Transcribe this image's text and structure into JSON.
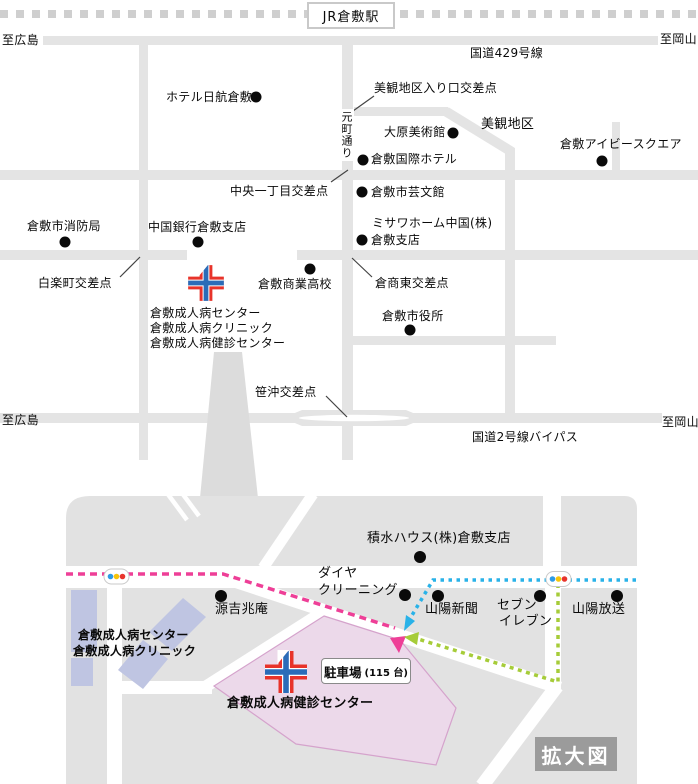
{
  "station": {
    "label": "JR倉敷駅"
  },
  "upper": {
    "to_hiroshima_top": "至広島",
    "to_okayama_top": "至岡山",
    "route429": "国道429号線",
    "to_hiroshima_bottom": "至広島",
    "to_okayama_bottom": "至岡山",
    "bypass": "国道2号線バイパス",
    "motomachi": "元町通り",
    "places": {
      "hotel_nikko": "ホテル日航倉敷",
      "ohara_museum": "大原美術館",
      "bikan_district": "美観地区",
      "kokusai_hotel": "倉敷国際ホテル",
      "ivy_square": "倉敷アイビースクエア",
      "geibunkan": "倉敷市芸文館",
      "misawa_line1": "ミサワホーム中国(株)",
      "misawa_line2": "倉敷支店",
      "fire_dept": "倉敷市消防局",
      "chugoku_bank": "中国銀行倉敷支店",
      "shogyo_hs": "倉敷商業高校",
      "city_hall": "倉敷市役所"
    },
    "intersections": {
      "bikan_entrance": "美観地区入り口交差点",
      "chuo_itchome": "中央一丁目交差点",
      "hakuraku": "白楽町交差点",
      "kurasho_east": "倉商東交差点",
      "sasaoki": "笹沖交差点"
    },
    "hospital_line1": "倉敷成人病センター",
    "hospital_line2": "倉敷成人病クリニック",
    "hospital_line3": "倉敷成人病健診センター"
  },
  "lower": {
    "places": {
      "sekisui": "積水ハウス(株)倉敷支店",
      "daiya_line1": "ダイヤ",
      "daiya_line2": "クリーニング",
      "genkitchoan": "源吉兆庵",
      "sanyo_shimbun": "山陽新聞",
      "seven_line1": "セブン",
      "seven_line2": "イレブン",
      "sanyo_broadcast": "山陽放送"
    },
    "hospital_line1": "倉敷成人病センター",
    "hospital_line2": "倉敷成人病クリニック",
    "kenshin_center": "倉敷成人病健診センター",
    "parking_label": "駐車場",
    "parking_capacity": "(115 台)",
    "enlarged_label": "拡大図"
  },
  "colors": {
    "road": "#e4e4e4",
    "railway_dash": "#cfcfcf",
    "block_gray": "#e2e2e2",
    "route_pink": "#ee3f97",
    "route_blue": "#29b2e8",
    "route_green": "#a6cc39",
    "building_blue": "#bfc5e2",
    "parking_fill": "#ecd9ea",
    "cross_red": "#e8332a",
    "cross_blue": "#2b6cb8"
  }
}
